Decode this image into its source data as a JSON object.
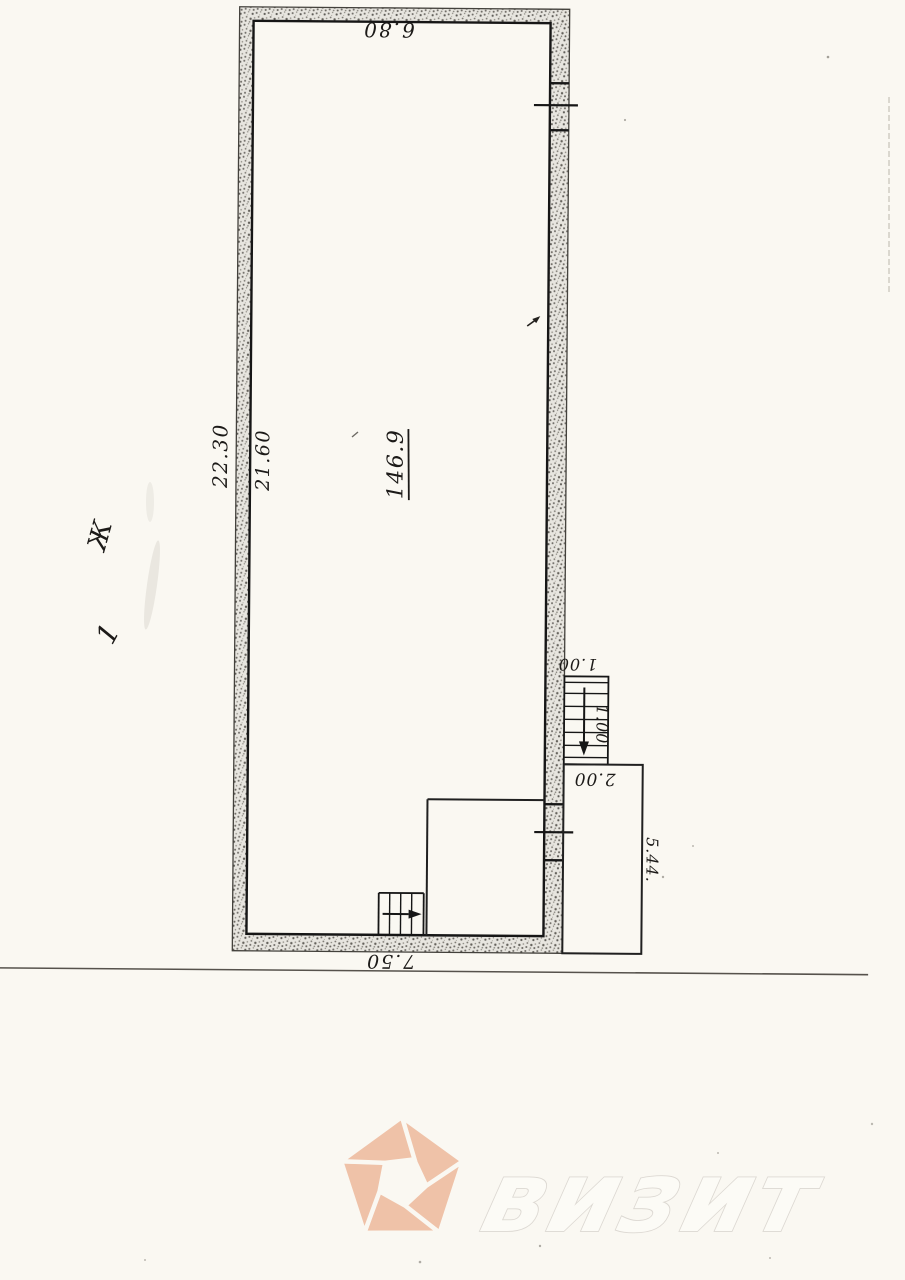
{
  "document": {
    "kind_label": "scanned floor plan page"
  },
  "plan": {
    "dimensions": {
      "top_width": "6.80",
      "left_outer": "22.30",
      "left_inner": "21.60",
      "bottom_width": "7.50",
      "stair_width": "1.00",
      "stair_depth": "1.00",
      "annex_top": "2.00",
      "annex_side": "5.44."
    },
    "area_label": "146.9",
    "marks": {
      "letter_mark": "Ж",
      "number_mark": "1"
    },
    "colors": {
      "ink": "#1c1a18",
      "wall_fill_base": "#e7e5df",
      "paper": "#faf8f2"
    }
  },
  "watermark": {
    "text": "визит",
    "logo_color": "#efc2a8",
    "text_outline_color": "#dcd8d2",
    "text_fill_color": "#fcfbf6"
  }
}
